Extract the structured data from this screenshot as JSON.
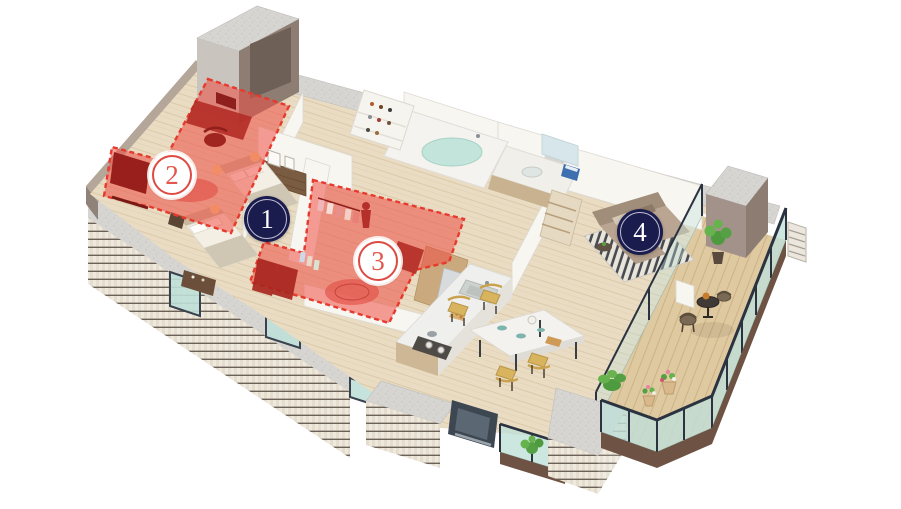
{
  "scene": {
    "width": 901,
    "height": 509,
    "background": "#ffffff",
    "type": "isometric-apartment-floorplan"
  },
  "markers": [
    {
      "label": "1",
      "style": "navy",
      "x": 267,
      "y": 219,
      "highlighted": false
    },
    {
      "label": "2",
      "style": "red",
      "x": 172,
      "y": 175,
      "highlighted": true
    },
    {
      "label": "3",
      "style": "red",
      "x": 378,
      "y": 261,
      "highlighted": true
    },
    {
      "label": "4",
      "style": "navy",
      "x": 640,
      "y": 232,
      "highlighted": false
    }
  ],
  "palette": {
    "marker_navy": "#1b1c4e",
    "marker_navy_ring": "#d8d5e4",
    "marker_red": "#dd4a41",
    "marker_red_text": "#e2584e",
    "highlight_fill": "#ef4f44",
    "highlight_border": "#e63a2e",
    "wood_floor": "#e9dcc3",
    "balcony_deck": "#dfc9a0",
    "concrete": "#d4d3cf",
    "wall_white": "#f8f6f1",
    "taupe_wall": "#a3928a",
    "glass": "#bfe0d8",
    "railing": "#2c3340",
    "fascia_brown": "#6e5344",
    "facade_tile": "#efe9dd",
    "sofa_taupe": "#b9a591",
    "chair_yellow": "#d9b45e",
    "marble_table": "#f3f2ef",
    "plant_green": "#55a044"
  }
}
